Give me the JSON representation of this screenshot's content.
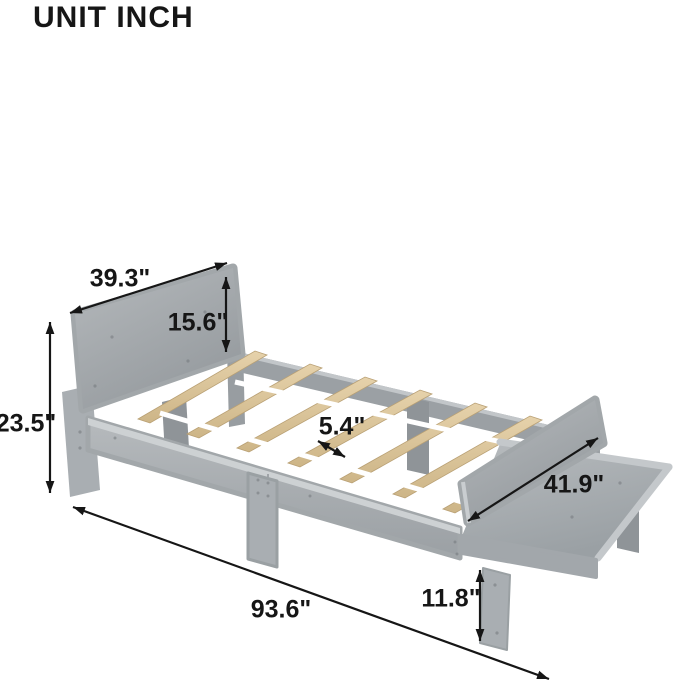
{
  "title": "UNIT INCH",
  "labels": {
    "headboard_width": "39.3\"",
    "headboard_panel_height": "15.6\"",
    "headboard_height": "23.5\"",
    "slat_gap": "5.4\"",
    "guard_rail_length": "41.9\"",
    "bed_length": "93.6\"",
    "leg_height": "11.8\""
  },
  "colors": {
    "frame": "#a9aeb2",
    "frame_light": "#c9cdd0",
    "frame_dark": "#90959a",
    "slat": "#d9c094",
    "strap": "#ffffff",
    "text": "#161616",
    "background": "#ffffff"
  }
}
